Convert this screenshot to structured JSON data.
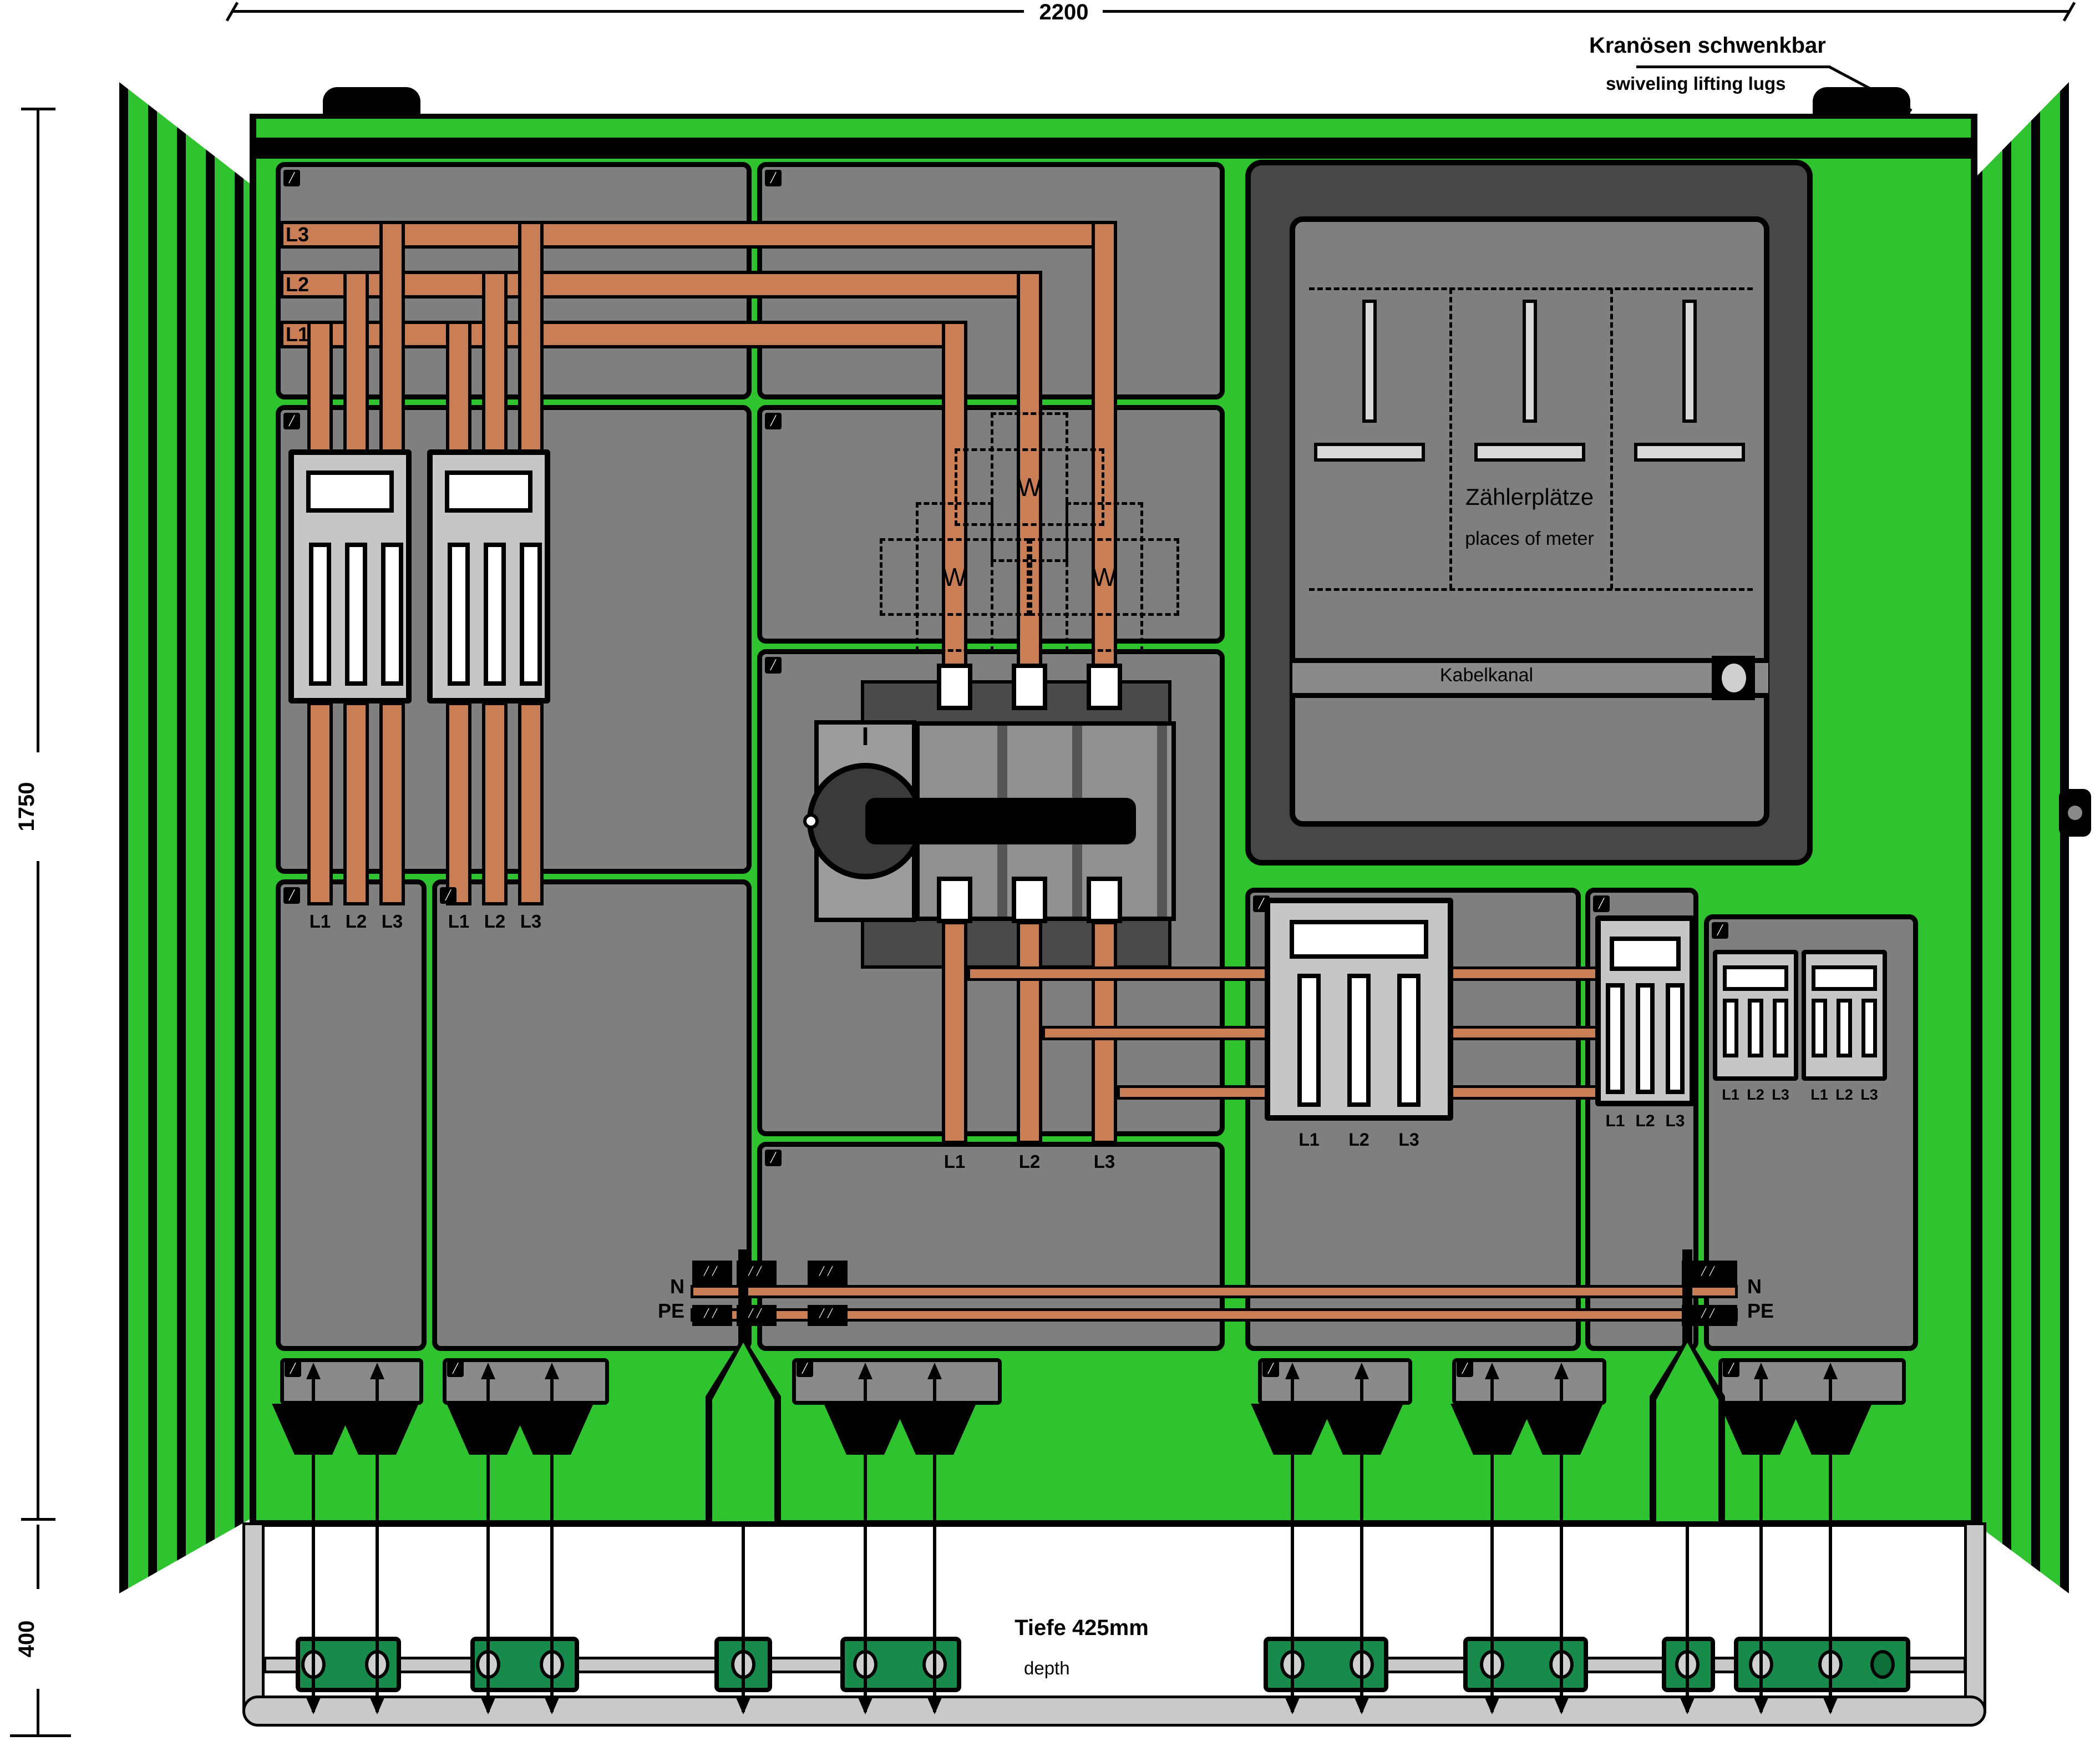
{
  "dimensions": {
    "width": "2200",
    "height": "1750",
    "base_height": "400",
    "depth_de": "Tiefe 425mm",
    "depth_en": "depth"
  },
  "callouts": {
    "lifting_lugs_de": "Kranösen schwenkbar",
    "lifting_lugs_en": "swiveling lifting lugs"
  },
  "meter_panel": {
    "title_de": "Zählerplätze",
    "title_en": "places of meter",
    "cable_duct_label": "Kabelkanal",
    "meter_positions": 3
  },
  "busbars": {
    "phase_top": [
      "L3",
      "L2",
      "L1"
    ],
    "neutral_label": "N",
    "earth_label": "PE"
  },
  "phases": [
    "L1",
    "L2",
    "L3"
  ],
  "labels": {
    "transformer": "W"
  },
  "switch": {
    "position_label": "I"
  },
  "colors": {
    "cabinet_green": "#2fc42f",
    "clamp_rail_green": "#188a4c",
    "copper": "#c97e55",
    "panel_gray": "#7f7f7f",
    "fuse_block_gray": "#c6c6c6",
    "meter_panel_dark": "#474747",
    "frame_metal_gray": "#c9c9c9"
  }
}
